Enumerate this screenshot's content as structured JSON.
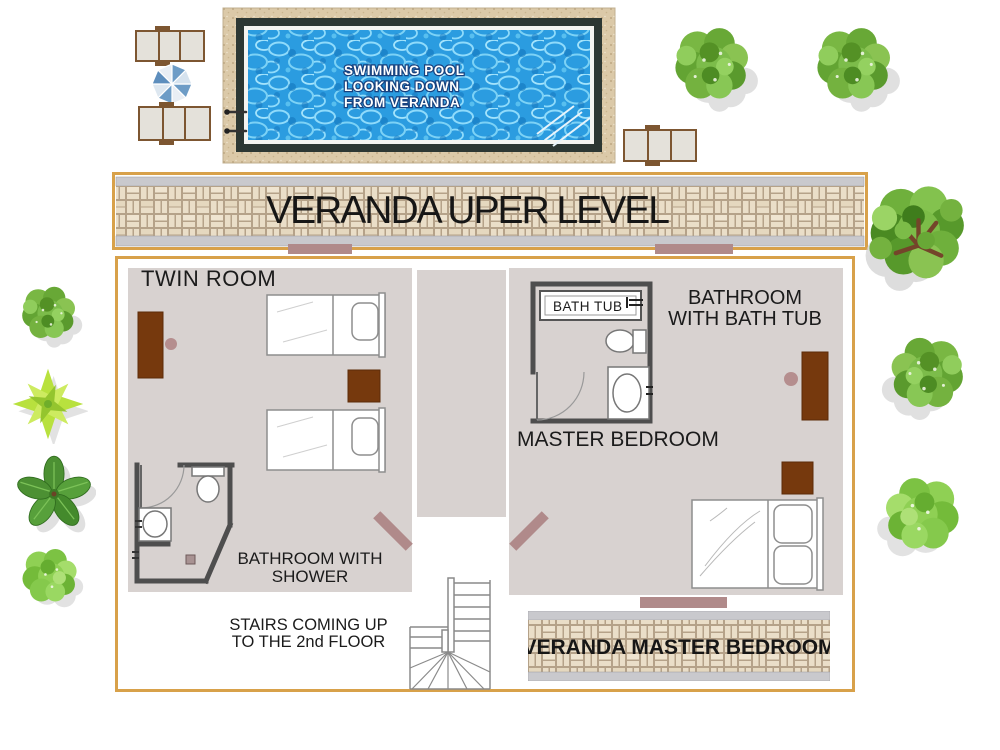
{
  "pool": {
    "label": [
      "SWIMMING POOL",
      "LOOKING DOWN",
      "FROM VERANDA"
    ]
  },
  "banners": {
    "upper_label": "VERANDA UPER LEVEL",
    "master_label": "VERANDA MASTER BEDROOM"
  },
  "plan": {
    "twin_room_label": "TWIN ROOM",
    "bathroom_tub_label": [
      "BATHROOM",
      "WITH BATH TUB"
    ],
    "master_bedroom_label": "MASTER BEDROOM",
    "bathroom_shower_label": [
      "BATHROOM WITH",
      "SHOWER"
    ],
    "stairs_label": [
      "STAIRS COMING UP",
      "TO THE 2nd FLOOR"
    ],
    "bath_tub_label": "BATH TUB"
  },
  "colors": {
    "accent_gold": "#d8a14a",
    "floor_gray": "#d8d2d0",
    "furniture_brown": "#76390d",
    "door_mauve": "#b08a8a",
    "knob_mauve": "#b58e8e",
    "pool_blue": "#2b9ce0",
    "pool_rim_dark": "#2c3733",
    "deck_tan": "#dbc9a8",
    "wall_dark": "#4e4e4e",
    "brick_tan": "#eadec8",
    "strip_gray": "#c9c9cd",
    "foliage_green": "#79b743"
  }
}
